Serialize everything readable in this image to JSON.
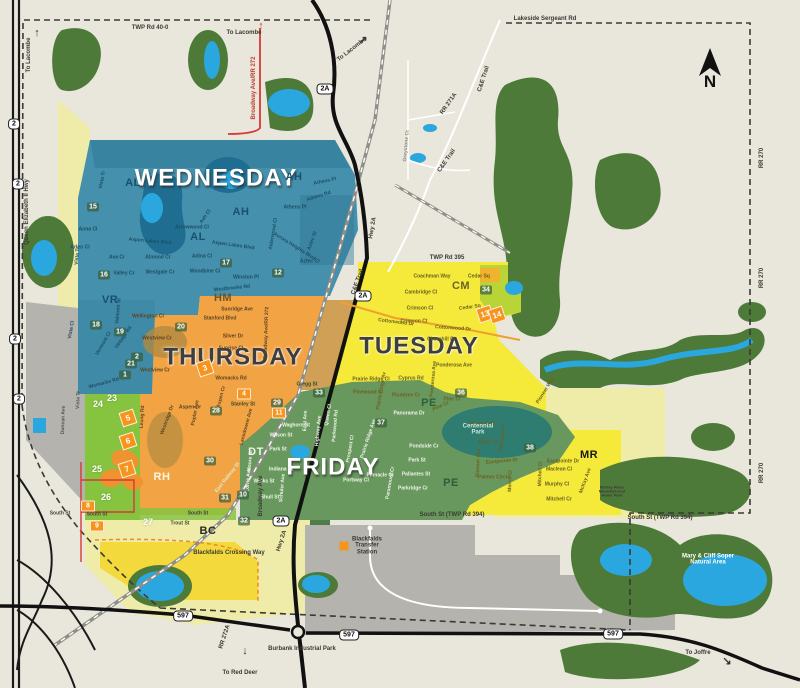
{
  "north": {
    "label": "N"
  },
  "colors": {
    "background": "#e9e6dc",
    "forest": "#4d7a39",
    "water": "#2aa7de",
    "wednesday": "#4590ad",
    "thursday": "#f2a445",
    "tuesday": "#f5e93a",
    "friday": "#68985e",
    "pale_yellow": "#efeba8",
    "bright_green": "#86c440",
    "gray_area": "#b5b3ae",
    "marker_orange": "#f7941d",
    "road_red": "#d63a34"
  },
  "zone_titles": [
    {
      "t": "WEDNESDAY",
      "x": 216,
      "y": 178,
      "style": "light"
    },
    {
      "t": "THURSDAY",
      "x": 233,
      "y": 357,
      "style": "dark"
    },
    {
      "t": "TUESDAY",
      "x": 419,
      "y": 346,
      "style": "dark"
    },
    {
      "t": "FRIDAY",
      "x": 333,
      "y": 467,
      "style": "light"
    }
  ],
  "area_codes": [
    {
      "t": "AL",
      "x": 133,
      "y": 184,
      "c": "#16516d"
    },
    {
      "t": "AL",
      "x": 198,
      "y": 238,
      "c": "#16516d"
    },
    {
      "t": "AH",
      "x": 294,
      "y": 178,
      "c": "#16516d"
    },
    {
      "t": "AH",
      "x": 241,
      "y": 213,
      "c": "#16516d"
    },
    {
      "t": "VR",
      "x": 110,
      "y": 301,
      "c": "#16516d"
    },
    {
      "t": "HM",
      "x": 223,
      "y": 299,
      "c": "#6a5426"
    },
    {
      "t": "CM",
      "x": 461,
      "y": 287,
      "c": "#6a6426"
    },
    {
      "t": "PE",
      "x": 429,
      "y": 404,
      "c": "#2c5e3c"
    },
    {
      "t": "PE",
      "x": 451,
      "y": 484,
      "c": "#2c5e3c"
    },
    {
      "t": "DT",
      "x": 256,
      "y": 453,
      "c": "#eef5e8"
    },
    {
      "t": "RH",
      "x": 162,
      "y": 478,
      "c": "#fdf6e3"
    },
    {
      "t": "BC",
      "x": 208,
      "y": 532,
      "c": "#2a2a22"
    },
    {
      "t": "MR",
      "x": 589,
      "y": 456,
      "c": "#1a1a14"
    }
  ],
  "markers_green": [
    {
      "n": "1",
      "x": 125,
      "y": 375
    },
    {
      "n": "2",
      "x": 137,
      "y": 357
    },
    {
      "n": "12",
      "x": 278,
      "y": 273
    },
    {
      "n": "15",
      "x": 93,
      "y": 207
    },
    {
      "n": "16",
      "x": 104,
      "y": 275
    },
    {
      "n": "17",
      "x": 226,
      "y": 263
    },
    {
      "n": "18",
      "x": 96,
      "y": 325
    },
    {
      "n": "19",
      "x": 120,
      "y": 332
    },
    {
      "n": "20",
      "x": 181,
      "y": 327
    },
    {
      "n": "21",
      "x": 131,
      "y": 364
    },
    {
      "n": "28",
      "x": 216,
      "y": 411
    },
    {
      "n": "29",
      "x": 277,
      "y": 403
    },
    {
      "n": "30",
      "x": 210,
      "y": 461
    },
    {
      "n": "31",
      "x": 225,
      "y": 498
    },
    {
      "n": "10",
      "x": 243,
      "y": 495
    },
    {
      "n": "32",
      "x": 244,
      "y": 521
    },
    {
      "n": "33",
      "x": 319,
      "y": 393
    },
    {
      "n": "34",
      "x": 486,
      "y": 290
    },
    {
      "n": "36",
      "x": 461,
      "y": 393
    },
    {
      "n": "37",
      "x": 381,
      "y": 423
    },
    {
      "n": "38",
      "x": 530,
      "y": 448
    }
  ],
  "markers_plain": [
    {
      "n": "23",
      "x": 112,
      "y": 398
    },
    {
      "n": "24",
      "x": 98,
      "y": 404
    },
    {
      "n": "25",
      "x": 97,
      "y": 469
    },
    {
      "n": "26",
      "x": 106,
      "y": 497
    },
    {
      "n": "27",
      "x": 148,
      "y": 522
    }
  ],
  "markers_orange": [
    {
      "n": "4",
      "x": 244,
      "y": 394
    },
    {
      "n": "8",
      "x": 88,
      "y": 506
    },
    {
      "n": "9",
      "x": 97,
      "y": 526
    },
    {
      "n": "11",
      "x": 279,
      "y": 413
    }
  ],
  "markers_tilted": [
    {
      "n": "3",
      "x": 205,
      "y": 368
    },
    {
      "n": "5",
      "x": 128,
      "y": 418
    },
    {
      "n": "6",
      "x": 128,
      "y": 441
    },
    {
      "n": "7",
      "x": 127,
      "y": 469
    },
    {
      "n": "13",
      "x": 485,
      "y": 314
    },
    {
      "n": "14",
      "x": 497,
      "y": 315
    }
  ],
  "road_labels": [
    {
      "t": "TWP Rd 40-0",
      "x": 150,
      "y": 28
    },
    {
      "t": "Lakeside Sergeant Rd",
      "x": 545,
      "y": 19
    },
    {
      "t": "TWP Rd 395",
      "x": 447,
      "y": 258
    },
    {
      "t": "South St (TWP Rd 394)",
      "x": 452,
      "y": 515
    },
    {
      "t": "South St (TWP Rd 394)",
      "x": 660,
      "y": 518
    },
    {
      "t": "Blackfalds Crossing Way",
      "x": 229,
      "y": 553
    },
    {
      "t": "Queen Elizabeth II Hwy",
      "x": 27,
      "y": 212,
      "r": -90
    },
    {
      "t": "Broadway Ave/RR 272",
      "x": 254,
      "y": 88,
      "r": -90,
      "c": "#c03a30"
    },
    {
      "t": "Hwy 2A",
      "x": 373,
      "y": 228,
      "r": -80
    },
    {
      "t": "Hwy 2A",
      "x": 282,
      "y": 541,
      "r": -72
    },
    {
      "t": "C&E Trail",
      "x": 484,
      "y": 79,
      "r": -72
    },
    {
      "t": "C&E Trail",
      "x": 447,
      "y": 161,
      "r": -55
    },
    {
      "t": "C&E Trail",
      "x": 358,
      "y": 282,
      "r": -70
    },
    {
      "t": "RR 271A",
      "x": 449,
      "y": 104,
      "r": -55
    },
    {
      "t": "RR 270",
      "x": 762,
      "y": 158,
      "r": -90
    },
    {
      "t": "RR 270",
      "x": 762,
      "y": 278,
      "r": -90
    },
    {
      "t": "RR 270",
      "x": 762,
      "y": 473,
      "r": -90
    },
    {
      "t": "RR 272A",
      "x": 225,
      "y": 637,
      "r": -72
    },
    {
      "t": "Broadway Ave",
      "x": 261,
      "y": 496,
      "r": -90
    }
  ],
  "pois": [
    {
      "t": "Burbank Industrial Park",
      "x": 302,
      "y": 649
    },
    {
      "t": "Blackfalds\nTransfer\nStation",
      "x": 367,
      "y": 546
    },
    {
      "t": "Mary & Cliff Soper\nNatural Area",
      "x": 708,
      "y": 560,
      "c": "#ffffff"
    },
    {
      "t": "Centennial\nPark",
      "x": 478,
      "y": 430,
      "c": "#cfe6da"
    },
    {
      "t": "McKay Place\nManufactured\nHome Park",
      "x": 612,
      "y": 492,
      "s": "4px"
    }
  ],
  "directions": [
    {
      "t": "To Lacombe",
      "x": 29,
      "y": 55,
      "r": -90
    },
    {
      "t": "To Lacombe",
      "x": 244,
      "y": 33
    },
    {
      "t": "To Lacombe",
      "x": 352,
      "y": 50,
      "r": -38
    },
    {
      "t": "To Red Deer",
      "x": 240,
      "y": 673
    },
    {
      "t": "To Joffre",
      "x": 698,
      "y": 653
    }
  ],
  "arrows": [
    {
      "g": "↑",
      "x": 37,
      "y": 33,
      "c": "#333"
    },
    {
      "g": "↑",
      "x": 261,
      "y": 26,
      "c": "#d63a34"
    },
    {
      "g": "↗",
      "x": 363,
      "y": 40,
      "c": "#333"
    },
    {
      "g": "↓",
      "x": 245,
      "y": 651,
      "c": "#333"
    },
    {
      "g": "↘",
      "x": 727,
      "y": 661,
      "c": "#333"
    }
  ],
  "shields": [
    {
      "t": "2",
      "x": 14,
      "y": 124
    },
    {
      "t": "2",
      "x": 18,
      "y": 184
    },
    {
      "t": "2",
      "x": 15,
      "y": 339
    },
    {
      "t": "2",
      "x": 19,
      "y": 399
    },
    {
      "t": "2A",
      "x": 325,
      "y": 89
    },
    {
      "t": "2A",
      "x": 363,
      "y": 296
    },
    {
      "t": "2A",
      "x": 281,
      "y": 521
    },
    {
      "t": "597",
      "x": 183,
      "y": 616
    },
    {
      "t": "597",
      "x": 349,
      "y": 635
    },
    {
      "t": "597",
      "x": 613,
      "y": 634
    }
  ],
  "street_labels": [
    {
      "t": "Vista Tr",
      "x": 103,
      "y": 180,
      "r": -80,
      "c": "#1d4e63"
    },
    {
      "t": "Anna Cl",
      "x": 88,
      "y": 230,
      "c": "#1d4e63"
    },
    {
      "t": "Arlen Cl",
      "x": 80,
      "y": 248,
      "c": "#1d4e63"
    },
    {
      "t": "Ava Cr",
      "x": 117,
      "y": 258,
      "c": "#1d4e63"
    },
    {
      "t": "Aspen Lakes Blvd",
      "x": 150,
      "y": 242,
      "r": 5,
      "c": "#1d4e63"
    },
    {
      "t": "Aspen Lakes Blvd",
      "x": 233,
      "y": 246,
      "r": 8,
      "c": "#1d4e63"
    },
    {
      "t": "Valley Cr",
      "x": 124,
      "y": 274,
      "c": "#1d4e63"
    },
    {
      "t": "Westgate Cr",
      "x": 160,
      "y": 273,
      "c": "#1d4e63"
    },
    {
      "t": "Almond Cr",
      "x": 158,
      "y": 258,
      "c": "#1d4e63"
    },
    {
      "t": "Adina Cl",
      "x": 202,
      "y": 257,
      "c": "#1d4e63"
    },
    {
      "t": "Woodbine Cl",
      "x": 205,
      "y": 272,
      "c": "#1d4e63"
    },
    {
      "t": "Arrowwood Cl",
      "x": 192,
      "y": 228,
      "c": "#1d4e63"
    },
    {
      "t": "Ash Cl",
      "x": 206,
      "y": 217,
      "r": -55,
      "c": "#1d4e63"
    },
    {
      "t": "Winston Pl",
      "x": 246,
      "y": 278,
      "c": "#1d4e63"
    },
    {
      "t": "Westbrooke Rd",
      "x": 232,
      "y": 289,
      "r": -6,
      "c": "#1d4e63"
    },
    {
      "t": "Athens Pl",
      "x": 325,
      "y": 182,
      "r": -12,
      "c": "#1d4e63"
    },
    {
      "t": "Athens Rd",
      "x": 319,
      "y": 197,
      "r": -18,
      "c": "#1d4e63"
    },
    {
      "t": "Athens Pl",
      "x": 295,
      "y": 208,
      "c": "#1d4e63"
    },
    {
      "t": "Aztec St",
      "x": 313,
      "y": 241,
      "r": -70,
      "c": "#1d4e63"
    },
    {
      "t": "Aztec Cr",
      "x": 310,
      "y": 262,
      "c": "#1d4e63"
    },
    {
      "t": "Aurora Heights Blvd",
      "x": 294,
      "y": 247,
      "r": 32,
      "c": "#1d4e63"
    },
    {
      "t": "Alderwood Cl",
      "x": 274,
      "y": 234,
      "r": -80,
      "c": "#1d4e63"
    },
    {
      "t": "Vista Tr",
      "x": 78,
      "y": 256,
      "r": -85,
      "c": "#1d4e63"
    },
    {
      "t": "Valmont St",
      "x": 119,
      "y": 311,
      "r": -85,
      "c": "#1d4e63"
    },
    {
      "t": "Vermont Cl",
      "x": 104,
      "y": 344,
      "r": -60,
      "c": "#1d4e63"
    },
    {
      "t": "Vintage Rd",
      "x": 124,
      "y": 338,
      "r": -55,
      "c": "#1d4e63"
    },
    {
      "t": "Vista Cl",
      "x": 72,
      "y": 330,
      "r": -80,
      "c": "#1d4e63"
    },
    {
      "t": "Womacks Rd",
      "x": 104,
      "y": 384,
      "r": -15,
      "c": "#1d4e63"
    },
    {
      "t": "Wellington Cl",
      "x": 148,
      "y": 317,
      "c": "#5d4423"
    },
    {
      "t": "Sunridge Ave",
      "x": 237,
      "y": 310,
      "c": "#5d4423"
    },
    {
      "t": "Stanford Blvd",
      "x": 220,
      "y": 319,
      "c": "#5d4423"
    },
    {
      "t": "Silver Dr",
      "x": 233,
      "y": 337,
      "c": "#5d4423"
    },
    {
      "t": "Sunrise Cl",
      "x": 231,
      "y": 349,
      "c": "#5d4423"
    },
    {
      "t": "Westview Cr",
      "x": 157,
      "y": 339,
      "c": "#5d4423"
    },
    {
      "t": "Westview Cr",
      "x": 155,
      "y": 371,
      "c": "#5d4423"
    },
    {
      "t": "Womacks Rd",
      "x": 231,
      "y": 379,
      "c": "#5d4423"
    },
    {
      "t": "Gregg St",
      "x": 307,
      "y": 385,
      "c": "#3a4a2a"
    },
    {
      "t": "Aspen Dr",
      "x": 190,
      "y": 408,
      "c": "#5d4423"
    },
    {
      "t": "Poplar Ave",
      "x": 196,
      "y": 413,
      "r": -80,
      "c": "#5d4423"
    },
    {
      "t": "Aspen Cr",
      "x": 222,
      "y": 397,
      "r": -75,
      "c": "#5d4423"
    },
    {
      "t": "Lansdowne Ave",
      "x": 247,
      "y": 427,
      "r": -75,
      "c": "#5d4423"
    },
    {
      "t": "Leung Rd",
      "x": 143,
      "y": 417,
      "r": -87,
      "c": "#5d4423"
    },
    {
      "t": "Stanley St",
      "x": 243,
      "y": 405,
      "c": "#3a4a2a"
    },
    {
      "t": "Westridge Dr",
      "x": 168,
      "y": 420,
      "r": -70,
      "c": "#5d4423"
    },
    {
      "t": "Broadway Ave/RR 272",
      "x": 267,
      "y": 333,
      "r": -88,
      "c": "#5d4423"
    },
    {
      "t": "Coachman Way",
      "x": 432,
      "y": 277,
      "c": "#6b6220"
    },
    {
      "t": "Cedar Sq",
      "x": 479,
      "y": 277,
      "c": "#6b6220"
    },
    {
      "t": "Cedar Sq",
      "x": 470,
      "y": 308,
      "r": -8,
      "c": "#6b6220"
    },
    {
      "t": "Cambridge Cl",
      "x": 421,
      "y": 293,
      "c": "#6b6220"
    },
    {
      "t": "Crimson Cl",
      "x": 420,
      "y": 309,
      "c": "#6b6220"
    },
    {
      "t": "Crimson Ct",
      "x": 414,
      "y": 322,
      "c": "#6b6220"
    },
    {
      "t": "Cottonwood Dr",
      "x": 396,
      "y": 323,
      "r": 7,
      "c": "#6b6220"
    },
    {
      "t": "Cottonwood Dr",
      "x": 453,
      "y": 329,
      "r": 4,
      "c": "#6b6220"
    },
    {
      "t": "Churchill Pl",
      "x": 441,
      "y": 340,
      "c": "#6b6220"
    },
    {
      "t": "Ponderosa Ave",
      "x": 454,
      "y": 366,
      "c": "#6b6220"
    },
    {
      "t": "Ponderosa Ave",
      "x": 434,
      "y": 379,
      "r": -85,
      "c": "#6b6220"
    },
    {
      "t": "Cyprus Rd",
      "x": 411,
      "y": 379,
      "c": "#6b6220"
    },
    {
      "t": "Plumtree Cr",
      "x": 406,
      "y": 396,
      "c": "#6b6220"
    },
    {
      "t": "Prairie Ridge Cl",
      "x": 371,
      "y": 380,
      "c": "#6b6220"
    },
    {
      "t": "Pinewood Cl",
      "x": 368,
      "y": 393,
      "c": "#6b6220"
    },
    {
      "t": "Prairie Ridge Av",
      "x": 382,
      "y": 391,
      "r": -80,
      "c": "#6b6220"
    },
    {
      "t": "Pine Cl",
      "x": 452,
      "y": 400,
      "c": "#6b6220"
    },
    {
      "t": "Pine Cr",
      "x": 441,
      "y": 407,
      "r": -25,
      "c": "#6b6220"
    },
    {
      "t": "Panorama Dr",
      "x": 409,
      "y": 414,
      "c": "#eef5e8"
    },
    {
      "t": "Pioneer Way",
      "x": 546,
      "y": 391,
      "r": -58,
      "c": "#6b6220"
    },
    {
      "t": "Pinetree Cl",
      "x": 482,
      "y": 425,
      "c": "#6b6220"
    },
    {
      "t": "Piper Cl",
      "x": 488,
      "y": 443,
      "c": "#6b6220"
    },
    {
      "t": "Pioneer Ave",
      "x": 479,
      "y": 463,
      "r": -88,
      "c": "#6b6220"
    },
    {
      "t": "Eastpointe Dr",
      "x": 502,
      "y": 462,
      "r": -5,
      "c": "#6b6220"
    },
    {
      "t": "Eastpointe Dr",
      "x": 563,
      "y": 462,
      "c": "#6b6220"
    },
    {
      "t": "Palmer Circle",
      "x": 494,
      "y": 478,
      "c": "#6b6220"
    },
    {
      "t": "Parkway Dr",
      "x": 503,
      "y": 438,
      "r": -85,
      "c": "#6b6220"
    },
    {
      "t": "Maclean Cl",
      "x": 559,
      "y": 470,
      "c": "#6b6220"
    },
    {
      "t": "Murphy Cl",
      "x": 557,
      "y": 485,
      "c": "#6b6220"
    },
    {
      "t": "Mitchell Cr",
      "x": 559,
      "y": 500,
      "c": "#6b6220"
    },
    {
      "t": "Mitchell Cl",
      "x": 541,
      "y": 474,
      "r": -88,
      "c": "#6b6220"
    },
    {
      "t": "Morris Cl",
      "x": 511,
      "y": 481,
      "r": -88,
      "c": "#6b6220"
    },
    {
      "t": "McKay Ave",
      "x": 586,
      "y": 481,
      "r": -70,
      "c": "#6b6220"
    },
    {
      "t": "Waghorn St",
      "x": 296,
      "y": 426,
      "c": "#eef5e8"
    },
    {
      "t": "Wilson St",
      "x": 281,
      "y": 436,
      "c": "#eef5e8"
    },
    {
      "t": "Park St",
      "x": 278,
      "y": 450,
      "c": "#eef5e8"
    },
    {
      "t": "Park St",
      "x": 417,
      "y": 461,
      "c": "#eef5e8"
    },
    {
      "t": "East Ave",
      "x": 306,
      "y": 421,
      "r": -88,
      "c": "#eef5e8"
    },
    {
      "t": "Highway Ave",
      "x": 319,
      "y": 431,
      "r": -85,
      "c": "#eef5e8"
    },
    {
      "t": "Queen Cl",
      "x": 329,
      "y": 415,
      "r": -80,
      "c": "#eef5e8"
    },
    {
      "t": "Indiana St",
      "x": 281,
      "y": 470,
      "c": "#eef5e8"
    },
    {
      "t": "Winks St",
      "x": 264,
      "y": 482,
      "c": "#eef5e8"
    },
    {
      "t": "Shull St",
      "x": 270,
      "y": 498,
      "c": "#eef5e8"
    },
    {
      "t": "Schuler Ave",
      "x": 283,
      "y": 488,
      "r": -85,
      "c": "#eef5e8"
    },
    {
      "t": "Lorne Ave",
      "x": 249,
      "y": 480,
      "r": -85,
      "c": "#eef5e8"
    },
    {
      "t": "Moore St",
      "x": 251,
      "y": 461,
      "r": -85,
      "c": "#eef5e8"
    },
    {
      "t": "Parkwood Rd",
      "x": 336,
      "y": 426,
      "r": -85,
      "c": "#eef5e8"
    },
    {
      "t": "Pinnacle Cl",
      "x": 380,
      "y": 476,
      "c": "#eef5e8"
    },
    {
      "t": "Portway Cl",
      "x": 356,
      "y": 481,
      "c": "#eef5e8"
    },
    {
      "t": "Paramount Cr",
      "x": 391,
      "y": 483,
      "r": -80,
      "c": "#eef5e8"
    },
    {
      "t": "Parkridge Cr",
      "x": 413,
      "y": 489,
      "c": "#eef5e8"
    },
    {
      "t": "Pallantes St",
      "x": 416,
      "y": 475,
      "c": "#eef5e8"
    },
    {
      "t": "Pondside Cr",
      "x": 424,
      "y": 447,
      "c": "#eef5e8"
    },
    {
      "t": "Prospect Cl",
      "x": 351,
      "y": 449,
      "r": -80,
      "c": "#eef5e8"
    },
    {
      "t": "Prairie Ridge Ave",
      "x": 369,
      "y": 439,
      "r": -72,
      "c": "#eef5e8"
    },
    {
      "t": "East Railway St",
      "x": 228,
      "y": 478,
      "r": -52,
      "c": "#dcebc8"
    },
    {
      "t": "Duncan Ave",
      "x": 64,
      "y": 420,
      "r": -88,
      "c": "#55554d"
    },
    {
      "t": "Vista Tr",
      "x": 79,
      "y": 400,
      "r": -88,
      "c": "#55554d"
    },
    {
      "t": "Trout St",
      "x": 180,
      "y": 524,
      "c": "#3a4a2a"
    },
    {
      "t": "South St",
      "x": 60,
      "y": 514,
      "c": "#44443c"
    },
    {
      "t": "South St",
      "x": 97,
      "y": 515,
      "c": "#44443c"
    },
    {
      "t": "South St",
      "x": 198,
      "y": 514,
      "c": "#44443c"
    },
    {
      "t": "Greystone Ct",
      "x": 407,
      "y": 146,
      "r": -85,
      "c": "#8a8a80"
    }
  ]
}
